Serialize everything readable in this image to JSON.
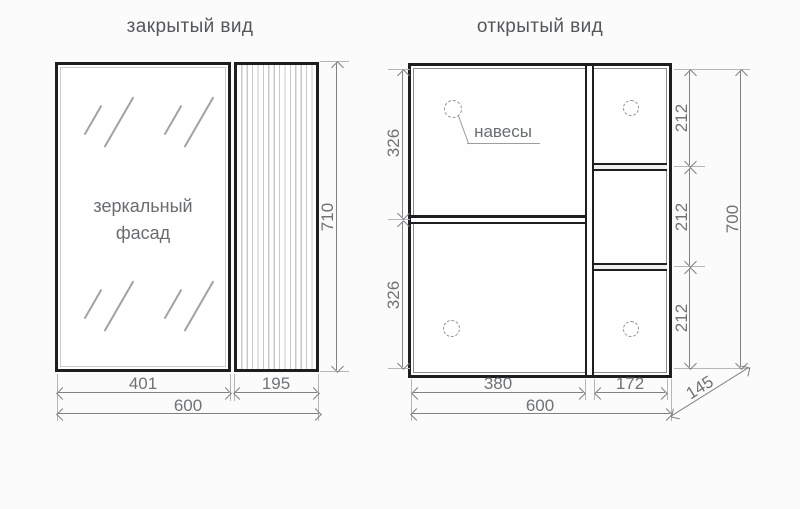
{
  "colors": {
    "outline": "#1d1e1f",
    "dimension_line": "#7f8285",
    "extension_line": "#b4b7b9",
    "label_text": "#6f7376",
    "title_text": "#54575a",
    "background": "#fbfbfb"
  },
  "closed_view": {
    "title": "закрытый вид",
    "mirror_label": "зеркальный фасад",
    "dims": {
      "mirror_width": "401",
      "side_panel_width": "195",
      "total_width": "600",
      "height": "710"
    }
  },
  "open_view": {
    "title": "открытый вид",
    "hinges_label": "навесы",
    "dims": {
      "upper_section_height": "326",
      "lower_section_height": "326",
      "right_cell_1": "212",
      "right_cell_2": "212",
      "right_cell_3": "212",
      "total_height": "700",
      "left_inner_width": "380",
      "right_inner_width": "172",
      "total_width": "600",
      "depth": "145"
    }
  }
}
